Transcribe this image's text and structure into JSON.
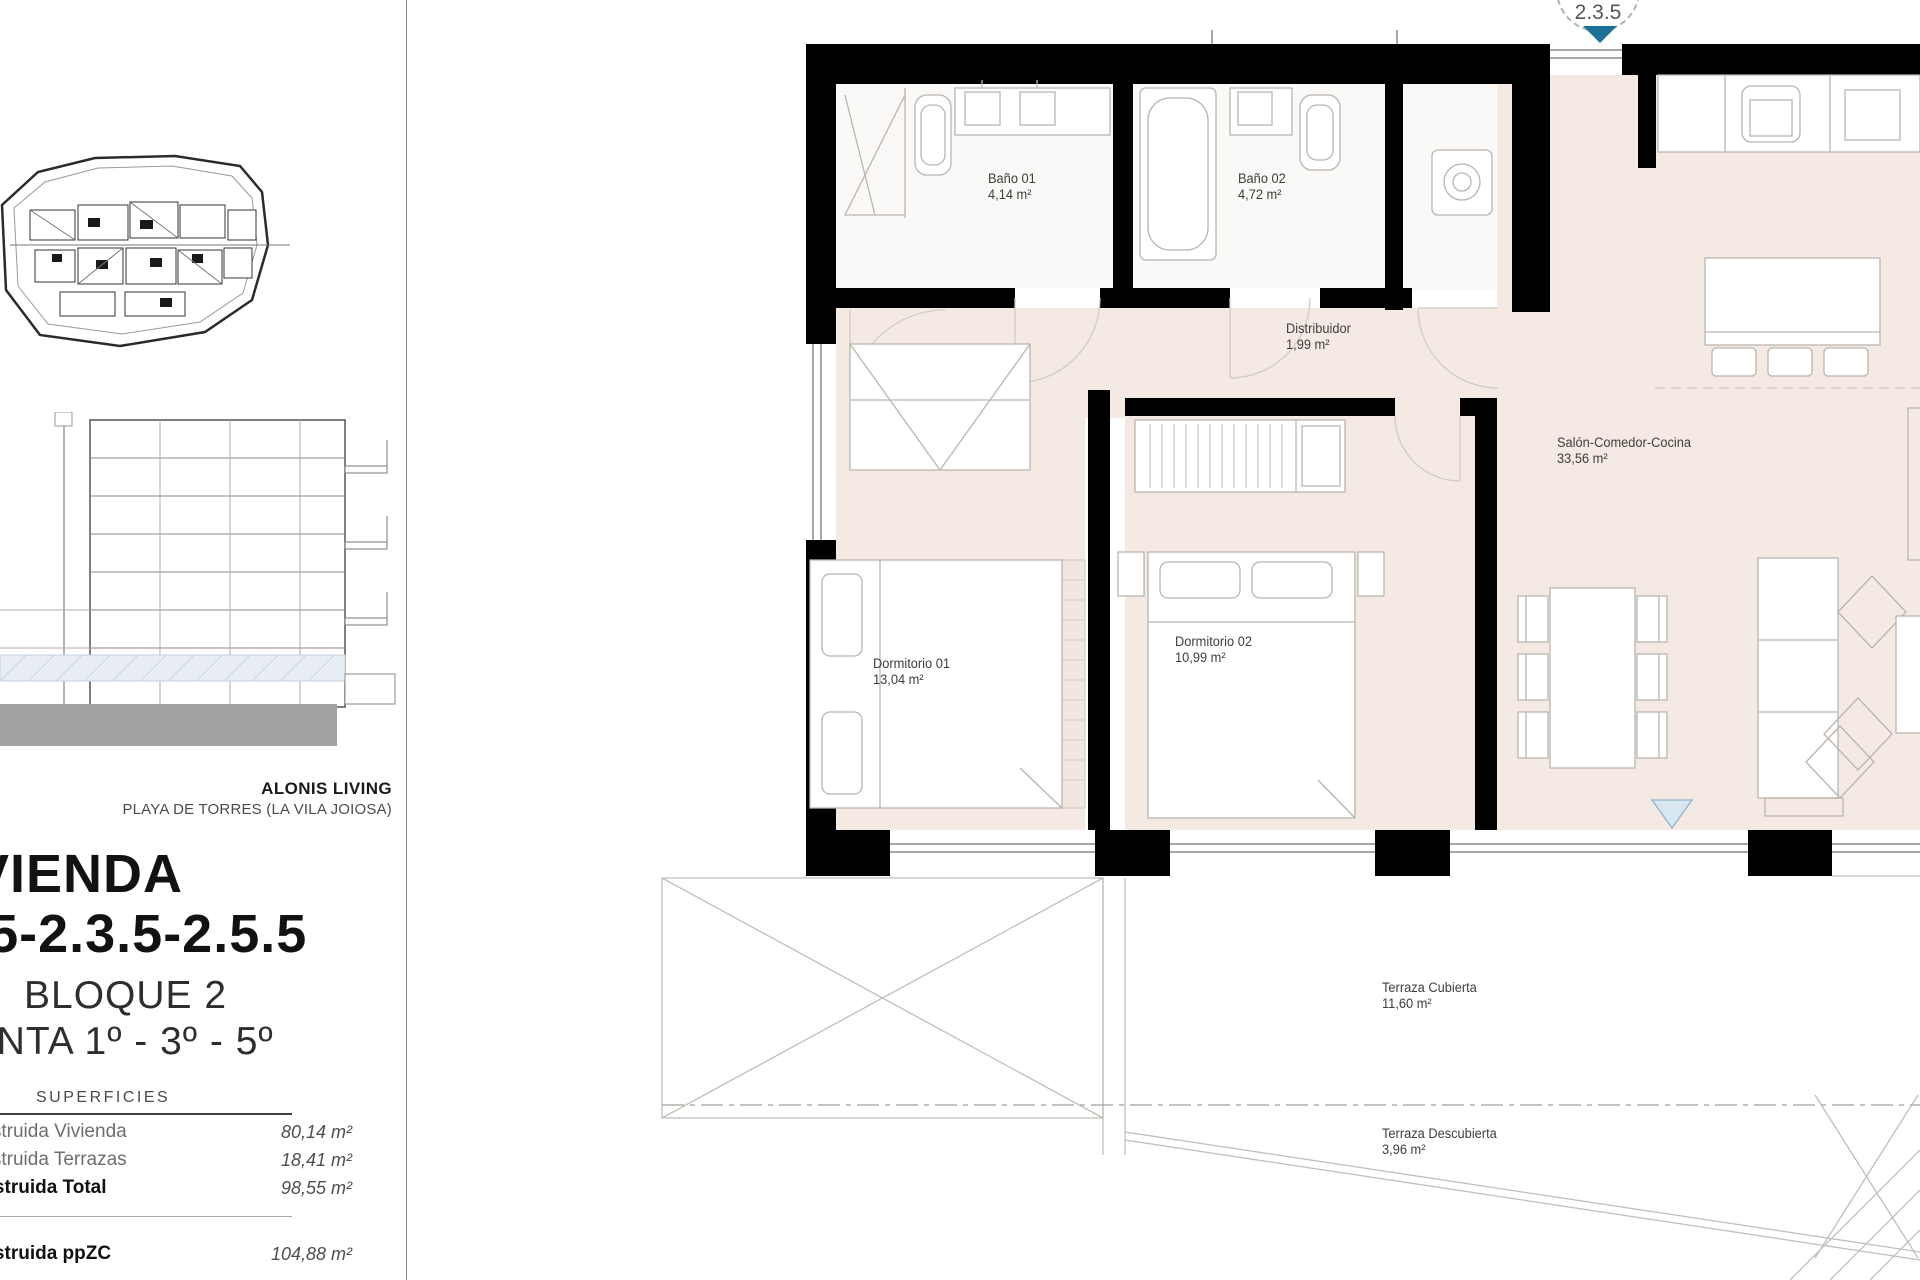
{
  "project": {
    "brand": "ALONIS LIVING",
    "location": "PLAYA DE TORRES (LA VILA JOIOSA)",
    "title": "VIVIENDA",
    "unit_numbers": "2.1.5-2.3.5-2.5.5",
    "block": "BLOQUE 2",
    "floors": "PLANTA 1º - 3º - 5º"
  },
  "surfaces": {
    "heading": "SUPERFICIES",
    "rows": [
      {
        "label": "Construida Vivienda",
        "value": "80,14 m²"
      },
      {
        "label": "Construida Terrazas",
        "value": "18,41 m²"
      },
      {
        "label": "Construida Total",
        "value": "98,55 m²"
      }
    ],
    "total_row": {
      "label": "Construida ppZC",
      "value": "104,88 m²"
    }
  },
  "floorplan": {
    "entrance_marker": "2.3.5",
    "rooms": [
      {
        "name": "Baño 01",
        "area": "4,14 m²"
      },
      {
        "name": "Baño 02",
        "area": "4,72 m²"
      },
      {
        "name": "Distribuidor",
        "area": "1,99 m²"
      },
      {
        "name": "Salón-Comedor-Cocina",
        "area": "33,56 m²"
      },
      {
        "name": "Dormitorio 01",
        "area": "13,04 m²"
      },
      {
        "name": "Dormitorio 02",
        "area": "10,99 m²"
      },
      {
        "name": "Terraza Cubierta",
        "area": "11,60 m²"
      },
      {
        "name": "Terraza Descubierta",
        "area": "3,96 m²"
      }
    ]
  },
  "colors": {
    "wall": "#000000",
    "room_fill": "#f4eae3",
    "entrance_marker_blue": "#1d6f96",
    "terrace_door_marker": "#d7e7f0",
    "ground_bar_gray": "#a3a3a3"
  }
}
